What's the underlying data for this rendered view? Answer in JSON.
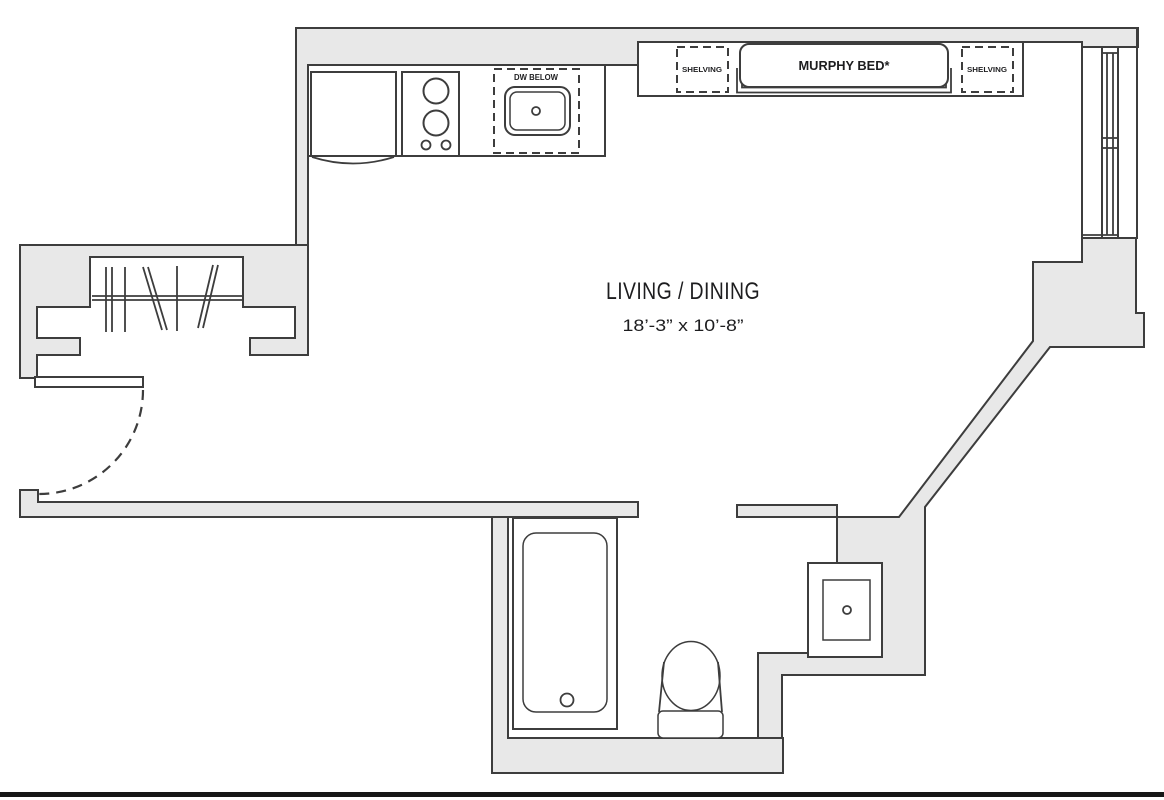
{
  "floor_plan": {
    "title_label": "LIVING / DINING",
    "dimensions_label": "18’-3” x 10’-8”",
    "murphy_bed_label": "MURPHY BED*",
    "shelving_left_label": "SHELVING",
    "shelving_right_label": "SHELVING",
    "dw_below_label": "DW BELOW",
    "colors": {
      "wall_fill": "#e8e8e8",
      "line": "#3d3d3d",
      "text": "#1d1d1f",
      "border_bottom": "#161616"
    }
  }
}
